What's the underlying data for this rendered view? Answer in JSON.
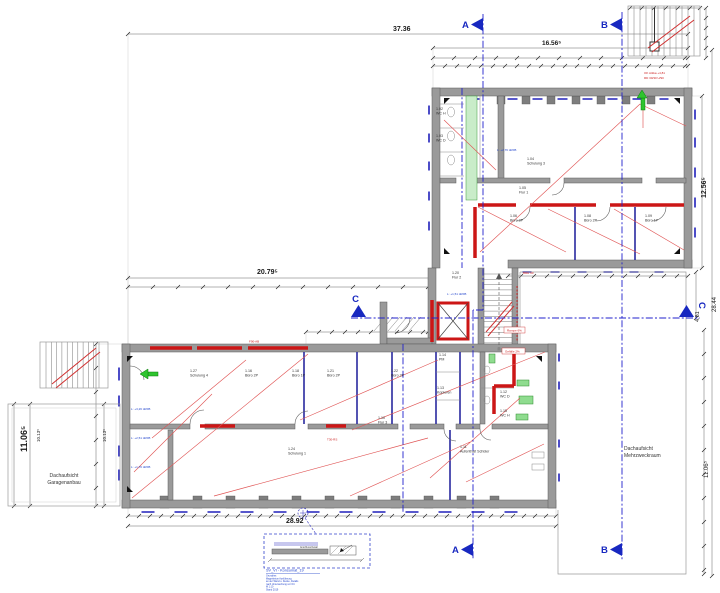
{
  "plan": {
    "dims": {
      "top_total": "37.36",
      "wing_width": "16.56⁵",
      "wing_height": "12.56⁵",
      "right_total": "28.44",
      "right_gap": "4.81",
      "right_lower": "11.06⁵",
      "left_height": "11.06⁵",
      "left_inner_a": "10.13⁵",
      "left_inner_b": "10.13⁵",
      "mid_width": "20.79⁵",
      "bottom_width": "28.92"
    },
    "sections": {
      "a": "A",
      "b": "B",
      "c": "C"
    },
    "areas": {
      "garage_1": "Dachaufsicht",
      "garage_2": "Garagenanbau",
      "mehrzweck_1": "Dachaufsicht",
      "mehrzweck_2": "Mehrzweckraum"
    },
    "rooms": [
      {
        "num": "1.02",
        "name": "WC H"
      },
      {
        "num": "1.03",
        "name": "WC D"
      },
      {
        "num": "1.04",
        "name": "Schulung 3"
      },
      {
        "num": "1.05",
        "name": "Flur 1"
      },
      {
        "num": "1.06",
        "name": "Büro 2P"
      },
      {
        "num": "1.08",
        "name": "Büro 2P"
      },
      {
        "num": "1.09",
        "name": "Büro 1P"
      },
      {
        "num": "1.20",
        "name": "Flur 2"
      },
      {
        "num": "1.27",
        "name": "Schulung 4"
      },
      {
        "num": "1.16",
        "name": "Büro 2P"
      },
      {
        "num": "1.18",
        "name": "Büro 1P"
      },
      {
        "num": "1.21",
        "name": "Büro 2P"
      },
      {
        "num": "1.22",
        "name": "Büro 2P"
      },
      {
        "num": "1.14",
        "name": "PM"
      },
      {
        "num": "1.13",
        "name": "Kopieren"
      },
      {
        "num": "1.10",
        "name": "Flur 3"
      },
      {
        "num": "1.12",
        "name": "WC D"
      },
      {
        "num": "1.15",
        "name": "WC H"
      },
      {
        "num": "1.24",
        "name": "Schulung 1"
      },
      {
        "num": "1.11",
        "name": "Aufenthalt Schüler"
      }
    ],
    "notes": [
      {
        "text": "OK Attika +4,81"
      },
      {
        "text": "RD 30/30 U/90"
      },
      {
        "text": "Rampe 6%"
      },
      {
        "text": "Gefälle 2%"
      },
      {
        "text": "L: +2,76 üRFB"
      },
      {
        "text": "L: +1,51 üRFB"
      },
      {
        "text": "L: +3,26 üRFB"
      },
      {
        "text": "L: +2,51 üRFB"
      },
      {
        "text": "L: +1,76 üRFB"
      },
      {
        "text": "F90-AB"
      },
      {
        "text": "T30-RS"
      },
      {
        "text": "BRH 90"
      },
      {
        "text": "Anschluss Detail"
      }
    ],
    "detail": {
      "ref": "SV_VI - Konsumat_19",
      "lines": [
        "Grundriss",
        "Magerbeton Ausführung",
        "an der Wand u. Decke, Details",
        "nach Untersuchung vor Ort",
        "M 1:10",
        "Stand 2019"
      ]
    }
  }
}
